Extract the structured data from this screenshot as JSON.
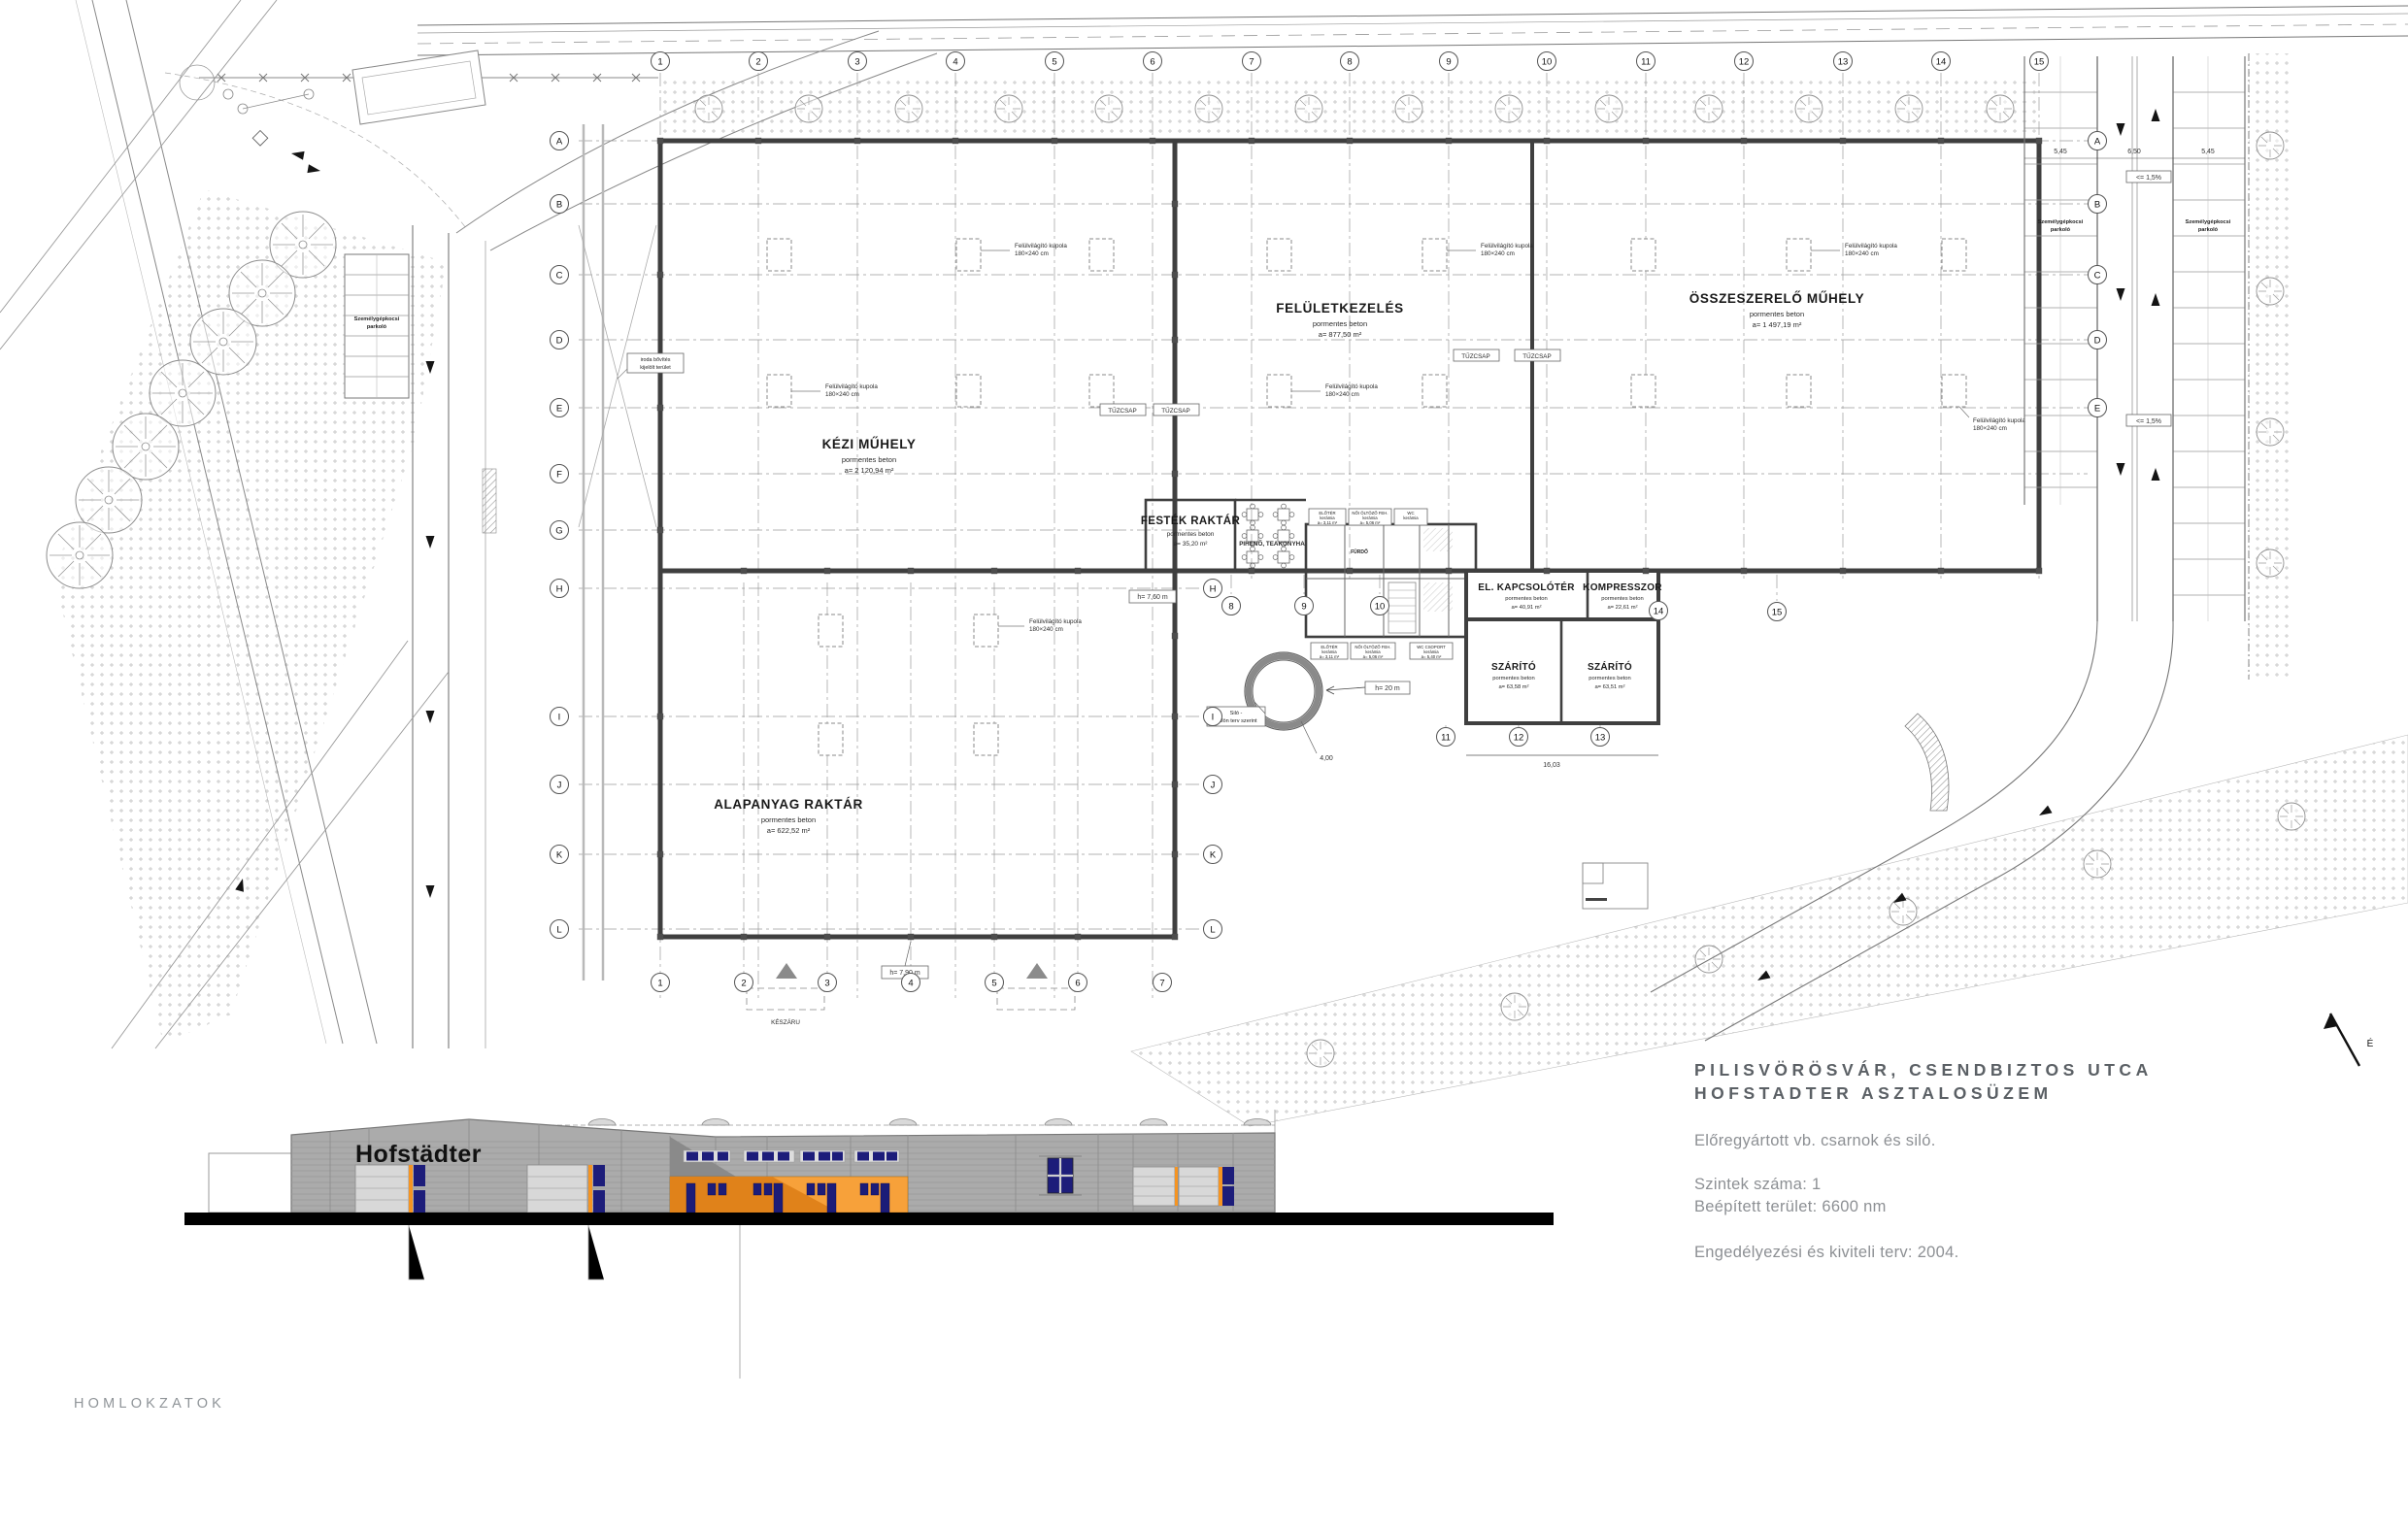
{
  "colors": {
    "accent_orange": "#f59b33",
    "accent_navy": "#1d1d7a",
    "facade_gray": "#ababab",
    "wall_dark": "#3f3f3f"
  },
  "title_block": {
    "line1": "PILISVÖRÖSVÁR, CSENDBIZTOS UTCA",
    "line2": "HOFSTADTER ASZTALOSÜZEM",
    "description": "Előregyártott vb. csarnok és siló.",
    "levels": "Szintek száma: 1",
    "built_area": "Beépített terület: 6600 nm",
    "permit": "Engedélyezési és kiviteli terv: 2004."
  },
  "footer": {
    "label": "HOMLOKZATOK"
  },
  "elevation": {
    "logo": "Hofstädter"
  },
  "plan": {
    "material": "pormentes beton",
    "rooms": {
      "kezi": {
        "name": "KÉZI MŰHELY",
        "area": "a= 2 120,94 m²"
      },
      "felulet": {
        "name": "FELÜLETKEZELÉS",
        "area": "a= 877,50 m²"
      },
      "ossze": {
        "name": "ÖSSZESZERELŐ MŰHELY",
        "area": "a= 1 497,19 m²"
      },
      "alapanyag": {
        "name": "ALAPANYAG RAKTÁR",
        "area": "a= 622,52 m²"
      },
      "festek": {
        "name": "FESTÉK RAKTÁR",
        "area": "a= 35,20 m²"
      },
      "elkapcs": {
        "name": "EL. KAPCSOLÓTÉR",
        "area": "a= 40,91 m²"
      },
      "kompresszor": {
        "name": "KOMPRESSZOR",
        "area": "a= 22,61 m²"
      },
      "szarito1": {
        "name": "SZÁRÍTÓ",
        "area": "a= 63,58 m²"
      },
      "szarito2": {
        "name": "SZÁRÍTÓ",
        "area": "a= 63,51 m²"
      },
      "piheno": {
        "name": "PIHENŐ, TEAKONYHA"
      }
    },
    "sanitary": {
      "material": "kerámia",
      "eloter": {
        "name": "ELŐTÉR",
        "area": "a= 3,11 m²"
      },
      "oltozo": {
        "name": "NŐI ÖLTÖZŐ FEH.",
        "area": "a= 5,06 m²"
      },
      "wccs": {
        "name": "WC CSOPORT",
        "area": "a= 5,40 m²"
      },
      "wc": {
        "name": "WC"
      },
      "furdo": {
        "name": "FÜRDŐ"
      }
    },
    "labels": {
      "skylight1": "Felülvilágító kupola",
      "skylight2": "180×240 cm",
      "fire_hydrant": "TŰZCSAP",
      "silo1": "Siló -",
      "silo2": "Külön terv szerint",
      "silo_height": "h= 20 m",
      "silo_diameter": "4,00",
      "clear_height_1": "h= 7,60 m",
      "clear_height_2": "h= 7,90 m",
      "keszaru": "KÉSZÁRU",
      "iroda1": "iroda bővítés",
      "iroda2": "kijelölt terület",
      "parking1": "Személygépkocsi",
      "parking2": "parkoló",
      "slope": "<= 1,5%",
      "dim_a": "5,45",
      "dim_b": "6,50",
      "dim_c": "16,03",
      "north": "É"
    },
    "grid": {
      "letters": [
        "A",
        "B",
        "C",
        "D",
        "E",
        "F",
        "G",
        "H",
        "I",
        "J",
        "K",
        "L"
      ],
      "numbers": [
        "1",
        "2",
        "3",
        "4",
        "5",
        "6",
        "7",
        "8",
        "9",
        "10",
        "11",
        "12",
        "13",
        "14",
        "15"
      ]
    }
  }
}
